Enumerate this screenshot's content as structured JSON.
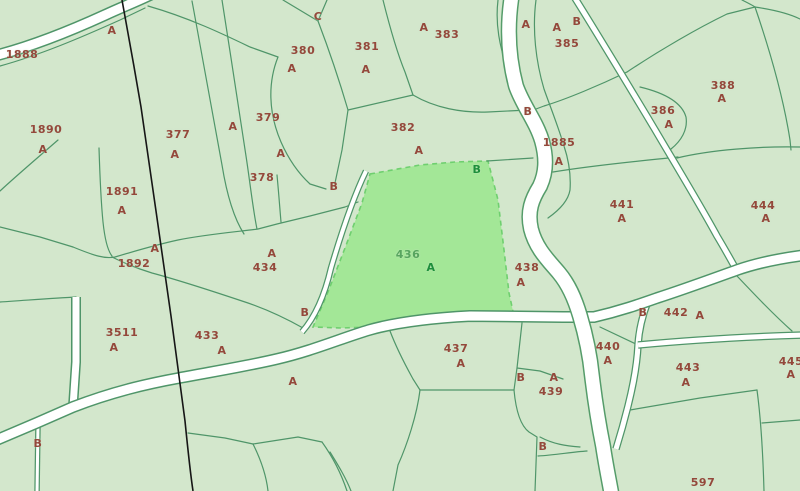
{
  "map": {
    "type": "cadastral-parcel-map",
    "selected_parcel": "436",
    "colors": {
      "background": "#d3e7cc",
      "parcel_line": "#4f9569",
      "road_fill": "#ffffff",
      "municipal_boundary": "#161616",
      "label_brown": "#94483b",
      "highlight_fill": "#a3e797",
      "highlight_number": "#57a45f",
      "highlight_letter": "#1e8f3c"
    },
    "labels": [
      {
        "t": "1888",
        "x": 22,
        "y": 55,
        "k": "n"
      },
      {
        "t": "A",
        "x": 112,
        "y": 31,
        "k": "a"
      },
      {
        "t": "1890",
        "x": 46,
        "y": 130,
        "k": "n"
      },
      {
        "t": "A",
        "x": 43,
        "y": 150,
        "k": "a"
      },
      {
        "t": "1891",
        "x": 122,
        "y": 192,
        "k": "n"
      },
      {
        "t": "A",
        "x": 122,
        "y": 211,
        "k": "a"
      },
      {
        "t": "A",
        "x": 155,
        "y": 249,
        "k": "a"
      },
      {
        "t": "1892",
        "x": 134,
        "y": 264,
        "k": "n"
      },
      {
        "t": "3511",
        "x": 122,
        "y": 333,
        "k": "n"
      },
      {
        "t": "A",
        "x": 114,
        "y": 348,
        "k": "a"
      },
      {
        "t": "377",
        "x": 178,
        "y": 135,
        "k": "n"
      },
      {
        "t": "A",
        "x": 175,
        "y": 155,
        "k": "a"
      },
      {
        "t": "A",
        "x": 233,
        "y": 127,
        "k": "a"
      },
      {
        "t": "379",
        "x": 268,
        "y": 118,
        "k": "n"
      },
      {
        "t": "A",
        "x": 281,
        "y": 154,
        "k": "a"
      },
      {
        "t": "378",
        "x": 262,
        "y": 178,
        "k": "n"
      },
      {
        "t": "380",
        "x": 303,
        "y": 51,
        "k": "n"
      },
      {
        "t": "A",
        "x": 292,
        "y": 69,
        "k": "a"
      },
      {
        "t": "C",
        "x": 318,
        "y": 17,
        "k": "a"
      },
      {
        "t": "381",
        "x": 367,
        "y": 47,
        "k": "n"
      },
      {
        "t": "A",
        "x": 366,
        "y": 70,
        "k": "a"
      },
      {
        "t": "A",
        "x": 424,
        "y": 28,
        "k": "a"
      },
      {
        "t": "383",
        "x": 447,
        "y": 35,
        "k": "n"
      },
      {
        "t": "382",
        "x": 403,
        "y": 128,
        "k": "n"
      },
      {
        "t": "A",
        "x": 419,
        "y": 151,
        "k": "a"
      },
      {
        "t": "B",
        "x": 334,
        "y": 187,
        "k": "a"
      },
      {
        "t": "434",
        "x": 265,
        "y": 268,
        "k": "n"
      },
      {
        "t": "A",
        "x": 272,
        "y": 254,
        "k": "a"
      },
      {
        "t": "B",
        "x": 305,
        "y": 313,
        "k": "a"
      },
      {
        "t": "433",
        "x": 207,
        "y": 336,
        "k": "n"
      },
      {
        "t": "A",
        "x": 222,
        "y": 351,
        "k": "a"
      },
      {
        "t": "B",
        "x": 38,
        "y": 444,
        "k": "a"
      },
      {
        "t": "A",
        "x": 293,
        "y": 382,
        "k": "a"
      },
      {
        "t": "436",
        "x": 408,
        "y": 255,
        "k": "hn"
      },
      {
        "t": "A",
        "x": 431,
        "y": 268,
        "k": "ha"
      },
      {
        "t": "B",
        "x": 477,
        "y": 170,
        "k": "ha"
      },
      {
        "t": "437",
        "x": 456,
        "y": 349,
        "k": "n"
      },
      {
        "t": "A",
        "x": 461,
        "y": 364,
        "k": "a"
      },
      {
        "t": "438",
        "x": 527,
        "y": 268,
        "k": "n"
      },
      {
        "t": "A",
        "x": 521,
        "y": 283,
        "k": "a"
      },
      {
        "t": "B",
        "x": 528,
        "y": 112,
        "k": "a"
      },
      {
        "t": "1885",
        "x": 559,
        "y": 143,
        "k": "n"
      },
      {
        "t": "A",
        "x": 559,
        "y": 162,
        "k": "a"
      },
      {
        "t": "A",
        "x": 526,
        "y": 25,
        "k": "a"
      },
      {
        "t": "A",
        "x": 557,
        "y": 28,
        "k": "a"
      },
      {
        "t": "B",
        "x": 577,
        "y": 22,
        "k": "a"
      },
      {
        "t": "385",
        "x": 567,
        "y": 44,
        "k": "n"
      },
      {
        "t": "386",
        "x": 663,
        "y": 111,
        "k": "n"
      },
      {
        "t": "A",
        "x": 669,
        "y": 125,
        "k": "a"
      },
      {
        "t": "388",
        "x": 723,
        "y": 86,
        "k": "n"
      },
      {
        "t": "A",
        "x": 722,
        "y": 99,
        "k": "a"
      },
      {
        "t": "441",
        "x": 622,
        "y": 205,
        "k": "n"
      },
      {
        "t": "A",
        "x": 622,
        "y": 219,
        "k": "a"
      },
      {
        "t": "444",
        "x": 763,
        "y": 206,
        "k": "n"
      },
      {
        "t": "A",
        "x": 766,
        "y": 219,
        "k": "a"
      },
      {
        "t": "B",
        "x": 643,
        "y": 313,
        "k": "a"
      },
      {
        "t": "442",
        "x": 676,
        "y": 313,
        "k": "n"
      },
      {
        "t": "A",
        "x": 700,
        "y": 316,
        "k": "a"
      },
      {
        "t": "B",
        "x": 521,
        "y": 378,
        "k": "a"
      },
      {
        "t": "A",
        "x": 554,
        "y": 378,
        "k": "a"
      },
      {
        "t": "439",
        "x": 551,
        "y": 392,
        "k": "n"
      },
      {
        "t": "B",
        "x": 543,
        "y": 447,
        "k": "a"
      },
      {
        "t": "440",
        "x": 608,
        "y": 347,
        "k": "n"
      },
      {
        "t": "A",
        "x": 608,
        "y": 361,
        "k": "a"
      },
      {
        "t": "443",
        "x": 688,
        "y": 368,
        "k": "n"
      },
      {
        "t": "A",
        "x": 686,
        "y": 383,
        "k": "a"
      },
      {
        "t": "445",
        "x": 791,
        "y": 362,
        "k": "n"
      },
      {
        "t": "A",
        "x": 791,
        "y": 375,
        "k": "a"
      },
      {
        "t": "597",
        "x": 703,
        "y": 483,
        "k": "n"
      }
    ]
  }
}
